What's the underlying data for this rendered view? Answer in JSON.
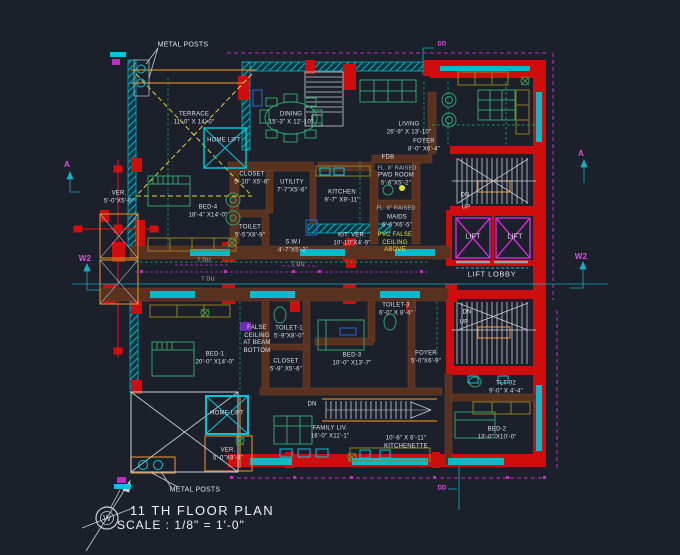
{
  "title": {
    "plan": "11 TH FLOOR PLAN",
    "scale": "SCALE : 1/8\" = 1'-0\""
  },
  "compass": {
    "letter": "W"
  },
  "colors": {
    "background": "#1b202b",
    "wall_red": "#cf0d0d",
    "wall_cyan": "#00c5da",
    "roof_magenta": "#c02ec0",
    "interior_wall_brown": "#58321f",
    "note_yellow": "#d8d832",
    "furniture_green": "#2fa36b",
    "terrace_dash_yellow": "#d8d832"
  },
  "labels": {
    "metal_posts_top": "METAL POSTS",
    "terrace": "TERRACE\n11'-0\" X 14'-0\"",
    "home_lift_top": "HOME LIFT",
    "dining": "DINING\n15'-3\" X 12'-10\"",
    "living": "LIVING\n26'-9\" X 13'-10\"",
    "foyer_top": "FOYER\n8'-0\" X6'-4\"",
    "fdb": "FDB",
    "fl_raised_1": "FL. 8\" RAISED",
    "pwd_room": "PWD ROOM\n5'-6\"X5'-2\"",
    "fl_raised_2": "FL. 8\" RAISED",
    "closet_top": "CLOSET\n5'-10\" X5'-6\"",
    "utility": "UTILITY\n7'-7\"X5'-6\"",
    "kitchen": "KITCHEN\n9'-7\" X9'-11\"",
    "bed4": "BED-4\n18'-4\" X14'-0\"",
    "toilet_top": "TOILET\n5'-5\"X8'-9\"",
    "swi": "S.W.I\n4'-7\"X5'-2\"",
    "kit_ver": "KIT. VER.\n10'-10\"X4'-9\"",
    "maids": "MAIDS\n6'-6\"X6'-5\"",
    "pvc_note": "PVC FALSE\nCEILING\nABOVE",
    "dn_top": "DN",
    "up_top": "UP",
    "lift_1": "LIFT",
    "lift_2": "LIFT",
    "lift_lobby": "LIFT LOBBY",
    "ver_left": "VER.\n5'-0\"X5'-0\"",
    "tdu_1": "T DU",
    "tdu_2": "T DU",
    "tdu_3": "T DU",
    "bed1": "BED-1\n20'-0\" X14'-0\"",
    "false_ceiling_note": "FALSE\nCEILING\nAT BEAM\nBOTTOM",
    "toilet1": "TOILET-1\n5'-9\"X8'-0\"",
    "closet_bottom": "CLOSET\n5'-9\" X5'-6\"",
    "toilet3": "TOILET-3\n6'-0\" X 8'-4\"",
    "bed3": "BED-3\n10'-0\" X13'-7\"",
    "foyer_bottom": "FOYER\n5'-0\"X6'-9\"",
    "dn_right": "DN",
    "up_right": "UP",
    "dn_center": "DN",
    "family_liv": "FAMILY LIV.\n16'-0\" X11'-1\"",
    "kitchenette": "10'-6\" X 6'-11\"\nKITCHENETTE",
    "tlt02": "TLT-02\n9'-0\" X 4'-4\"",
    "bed2": "BED-2\n13'-0\" X10'-0\"",
    "home_lift_bottom": "HOME LIFT",
    "ver_bottom": "VER.\n5'-0\"X8'-4\"",
    "metal_posts_bottom": "METAL POSTS"
  },
  "markers": {
    "a_left": "A",
    "w2_left": "W2",
    "a_right": "A",
    "w2_right": "W2",
    "dd_top": "DD",
    "dd_bottom": "DD"
  }
}
